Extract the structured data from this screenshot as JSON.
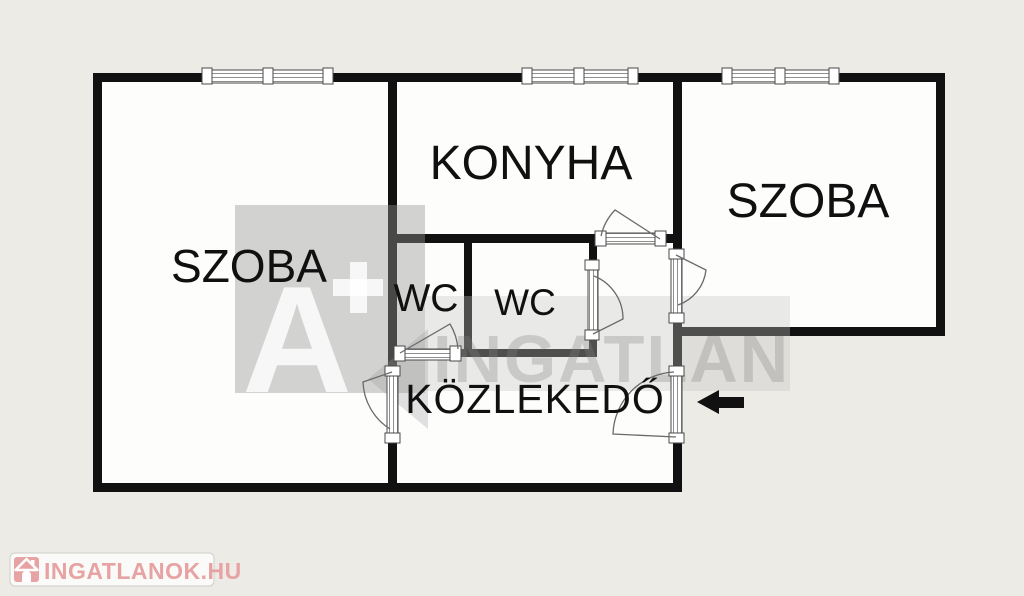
{
  "page": {
    "background_color": "#edebe6",
    "type": "floor-plan"
  },
  "floorplan": {
    "wall_color": "#111111",
    "floor_color": "#fdfdfc",
    "rooms": {
      "szoba_left": "SZOBA",
      "konyha": "KONYHA",
      "szoba_right": "SZOBA",
      "wc_left": "WC",
      "wc_right": "WC",
      "kozlekedo": "KÖZLEKEDŐ"
    },
    "icons": {
      "entrance_arrow": "arrow-left-icon",
      "window": "double-window-symbol",
      "door": "door-swing-symbol"
    }
  },
  "watermark": {
    "badge_letter": "A",
    "badge_plus": "+",
    "brand": "INGATLAN",
    "gray": "#d6d6d4"
  },
  "logo": {
    "text": "INGATLANOK.HU",
    "color": "#e7a3a3",
    "icon": "house-icon"
  }
}
